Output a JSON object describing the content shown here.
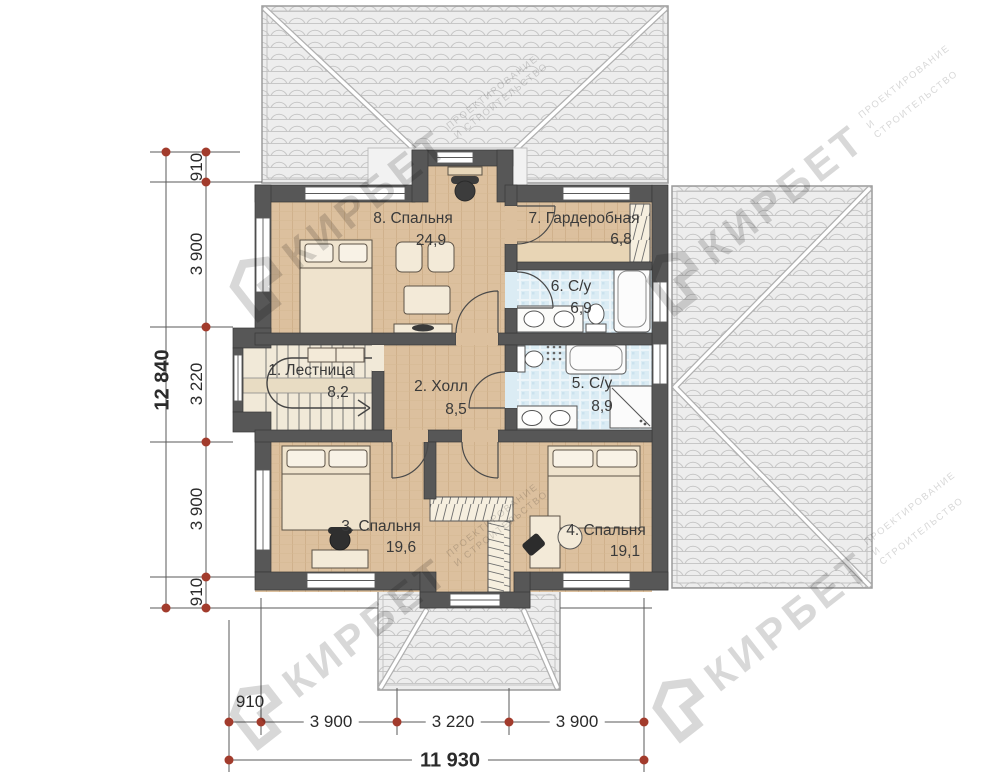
{
  "plan": {
    "rooms": [
      {
        "key": "bedroom8",
        "label": "8. Спальня",
        "area": "24,9"
      },
      {
        "key": "wardrobe7",
        "label": "7. Гардеробная",
        "area": "6,8"
      },
      {
        "key": "bath6",
        "label": "6. С/у",
        "area": "6,9"
      },
      {
        "key": "stairs1",
        "label": "1. Лестница",
        "area": "8,2"
      },
      {
        "key": "hall2",
        "label": "2. Холл",
        "area": "8,5"
      },
      {
        "key": "bath5",
        "label": "5. С/у",
        "area": "8,9"
      },
      {
        "key": "bedroom3",
        "label": "3. Спальня",
        "area": "19,6"
      },
      {
        "key": "bedroom4",
        "label": "4. Спальня",
        "area": "19,1"
      }
    ]
  },
  "dimensions": {
    "left_total": "12 840",
    "left_segments": [
      "910",
      "3 900",
      "3 220",
      "3 900",
      "910"
    ],
    "bottom_total": "11 930",
    "bottom_segments": [
      "910",
      "3 900",
      "3 220",
      "3 900"
    ]
  },
  "watermark": {
    "brand": "КИРБЕТ",
    "line1": "ПРОЕКТИРОВАНИЕ",
    "line2": "И СТРОИТЕЛЬСТВО"
  },
  "colors": {
    "wall": "#575757",
    "wood_floor": "#dcc09e",
    "bath_floor": "#dbecf4",
    "stair_floor": "#f1e9d8",
    "roof": "#ededed",
    "dimension_marker": "#a23b2c",
    "text": "#3a3a3a",
    "watermark": "#d8d8d8"
  }
}
